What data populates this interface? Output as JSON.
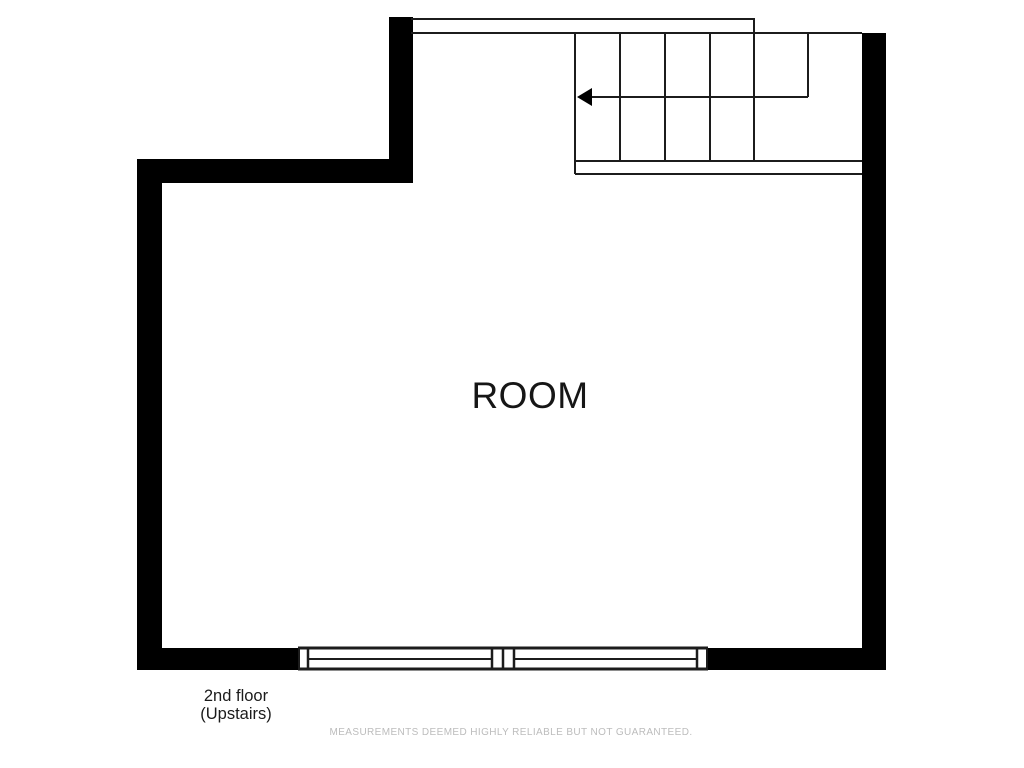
{
  "labels": {
    "room": "ROOM",
    "floor_line1": "2nd floor",
    "floor_line2": "(Upstairs)",
    "disclaimer": "MEASUREMENTS DEEMED HIGHLY RELIABLE BUT NOT GUARANTEED."
  },
  "colors": {
    "background": "#ffffff",
    "wall": "#000000",
    "line": "#1c1c1c",
    "text": "#1b1b1b",
    "disclaimer_text": "#bcbcbc"
  },
  "floorplan": {
    "canvas": {
      "width": 1024,
      "height": 768
    },
    "walls": [
      {
        "name": "wall-left",
        "x": 137,
        "y": 159,
        "w": 25,
        "h": 511
      },
      {
        "name": "wall-upper-notch",
        "x": 137,
        "y": 159,
        "w": 276,
        "h": 24
      },
      {
        "name": "wall-top-left-vertical",
        "x": 389,
        "y": 17,
        "w": 24,
        "h": 166
      },
      {
        "name": "wall-right",
        "x": 862,
        "y": 33,
        "w": 24,
        "h": 637
      },
      {
        "name": "wall-bottom-left",
        "x": 137,
        "y": 648,
        "w": 161,
        "h": 22
      },
      {
        "name": "wall-bottom-right",
        "x": 708,
        "y": 648,
        "w": 178,
        "h": 22
      }
    ],
    "lines": [
      {
        "name": "stair-landing-top-edge",
        "x1": 411,
        "y1": 19,
        "x2": 755,
        "y2": 19
      },
      {
        "name": "stair-landing-right-edge",
        "x1": 754,
        "y1": 18,
        "x2": 754,
        "y2": 33
      },
      {
        "name": "stair-top-edge",
        "x1": 411,
        "y1": 33,
        "x2": 862,
        "y2": 33
      },
      {
        "name": "stair-left-edge",
        "x1": 575,
        "y1": 33,
        "x2": 575,
        "y2": 174
      },
      {
        "name": "stair-tread-1",
        "x1": 620,
        "y1": 33,
        "x2": 620,
        "y2": 161
      },
      {
        "name": "stair-tread-2",
        "x1": 665,
        "y1": 33,
        "x2": 665,
        "y2": 161
      },
      {
        "name": "stair-tread-3",
        "x1": 710,
        "y1": 33,
        "x2": 710,
        "y2": 161
      },
      {
        "name": "stair-tread-4",
        "x1": 754,
        "y1": 33,
        "x2": 754,
        "y2": 161
      },
      {
        "name": "stair-run-right-edge",
        "x1": 808,
        "y1": 33,
        "x2": 808,
        "y2": 97
      },
      {
        "name": "stair-bottom-band-top",
        "x1": 575,
        "y1": 161,
        "x2": 862,
        "y2": 161
      },
      {
        "name": "stair-bottom-band-bottom",
        "x1": 575,
        "y1": 174,
        "x2": 862,
        "y2": 174
      },
      {
        "name": "window-band-top",
        "x1": 298,
        "y1": 648,
        "x2": 708,
        "y2": 648,
        "w": 3
      },
      {
        "name": "window-band-bottom",
        "x1": 298,
        "y1": 669,
        "x2": 708,
        "y2": 669,
        "w": 3
      },
      {
        "name": "window-left-cap",
        "x1": 299,
        "y1": 648,
        "x2": 299,
        "y2": 669
      },
      {
        "name": "window-1-left-jamb",
        "x1": 308,
        "y1": 648,
        "x2": 308,
        "y2": 669,
        "w": 2.5
      },
      {
        "name": "window-1-midrail",
        "x1": 308,
        "y1": 659,
        "x2": 492,
        "y2": 659
      },
      {
        "name": "window-1-right-jamb",
        "x1": 492,
        "y1": 648,
        "x2": 492,
        "y2": 669,
        "w": 2.5
      },
      {
        "name": "window-mullion",
        "x1": 503,
        "y1": 648,
        "x2": 503,
        "y2": 669,
        "w": 2.5
      },
      {
        "name": "window-2-left-jamb",
        "x1": 514,
        "y1": 648,
        "x2": 514,
        "y2": 669,
        "w": 2.5
      },
      {
        "name": "window-2-midrail",
        "x1": 514,
        "y1": 659,
        "x2": 697,
        "y2": 659
      },
      {
        "name": "window-2-right-jamb",
        "x1": 697,
        "y1": 648,
        "x2": 697,
        "y2": 669,
        "w": 2.5
      },
      {
        "name": "window-right-cap",
        "x1": 707,
        "y1": 648,
        "x2": 707,
        "y2": 669
      }
    ],
    "arrow": {
      "name": "stair-direction-arrow",
      "line": {
        "x1": 590,
        "y1": 97,
        "x2": 808,
        "y2": 97
      },
      "head": {
        "tip_x": 577,
        "tip_y": 97,
        "back_x": 592,
        "top_y": 88,
        "bottom_y": 106
      }
    }
  }
}
